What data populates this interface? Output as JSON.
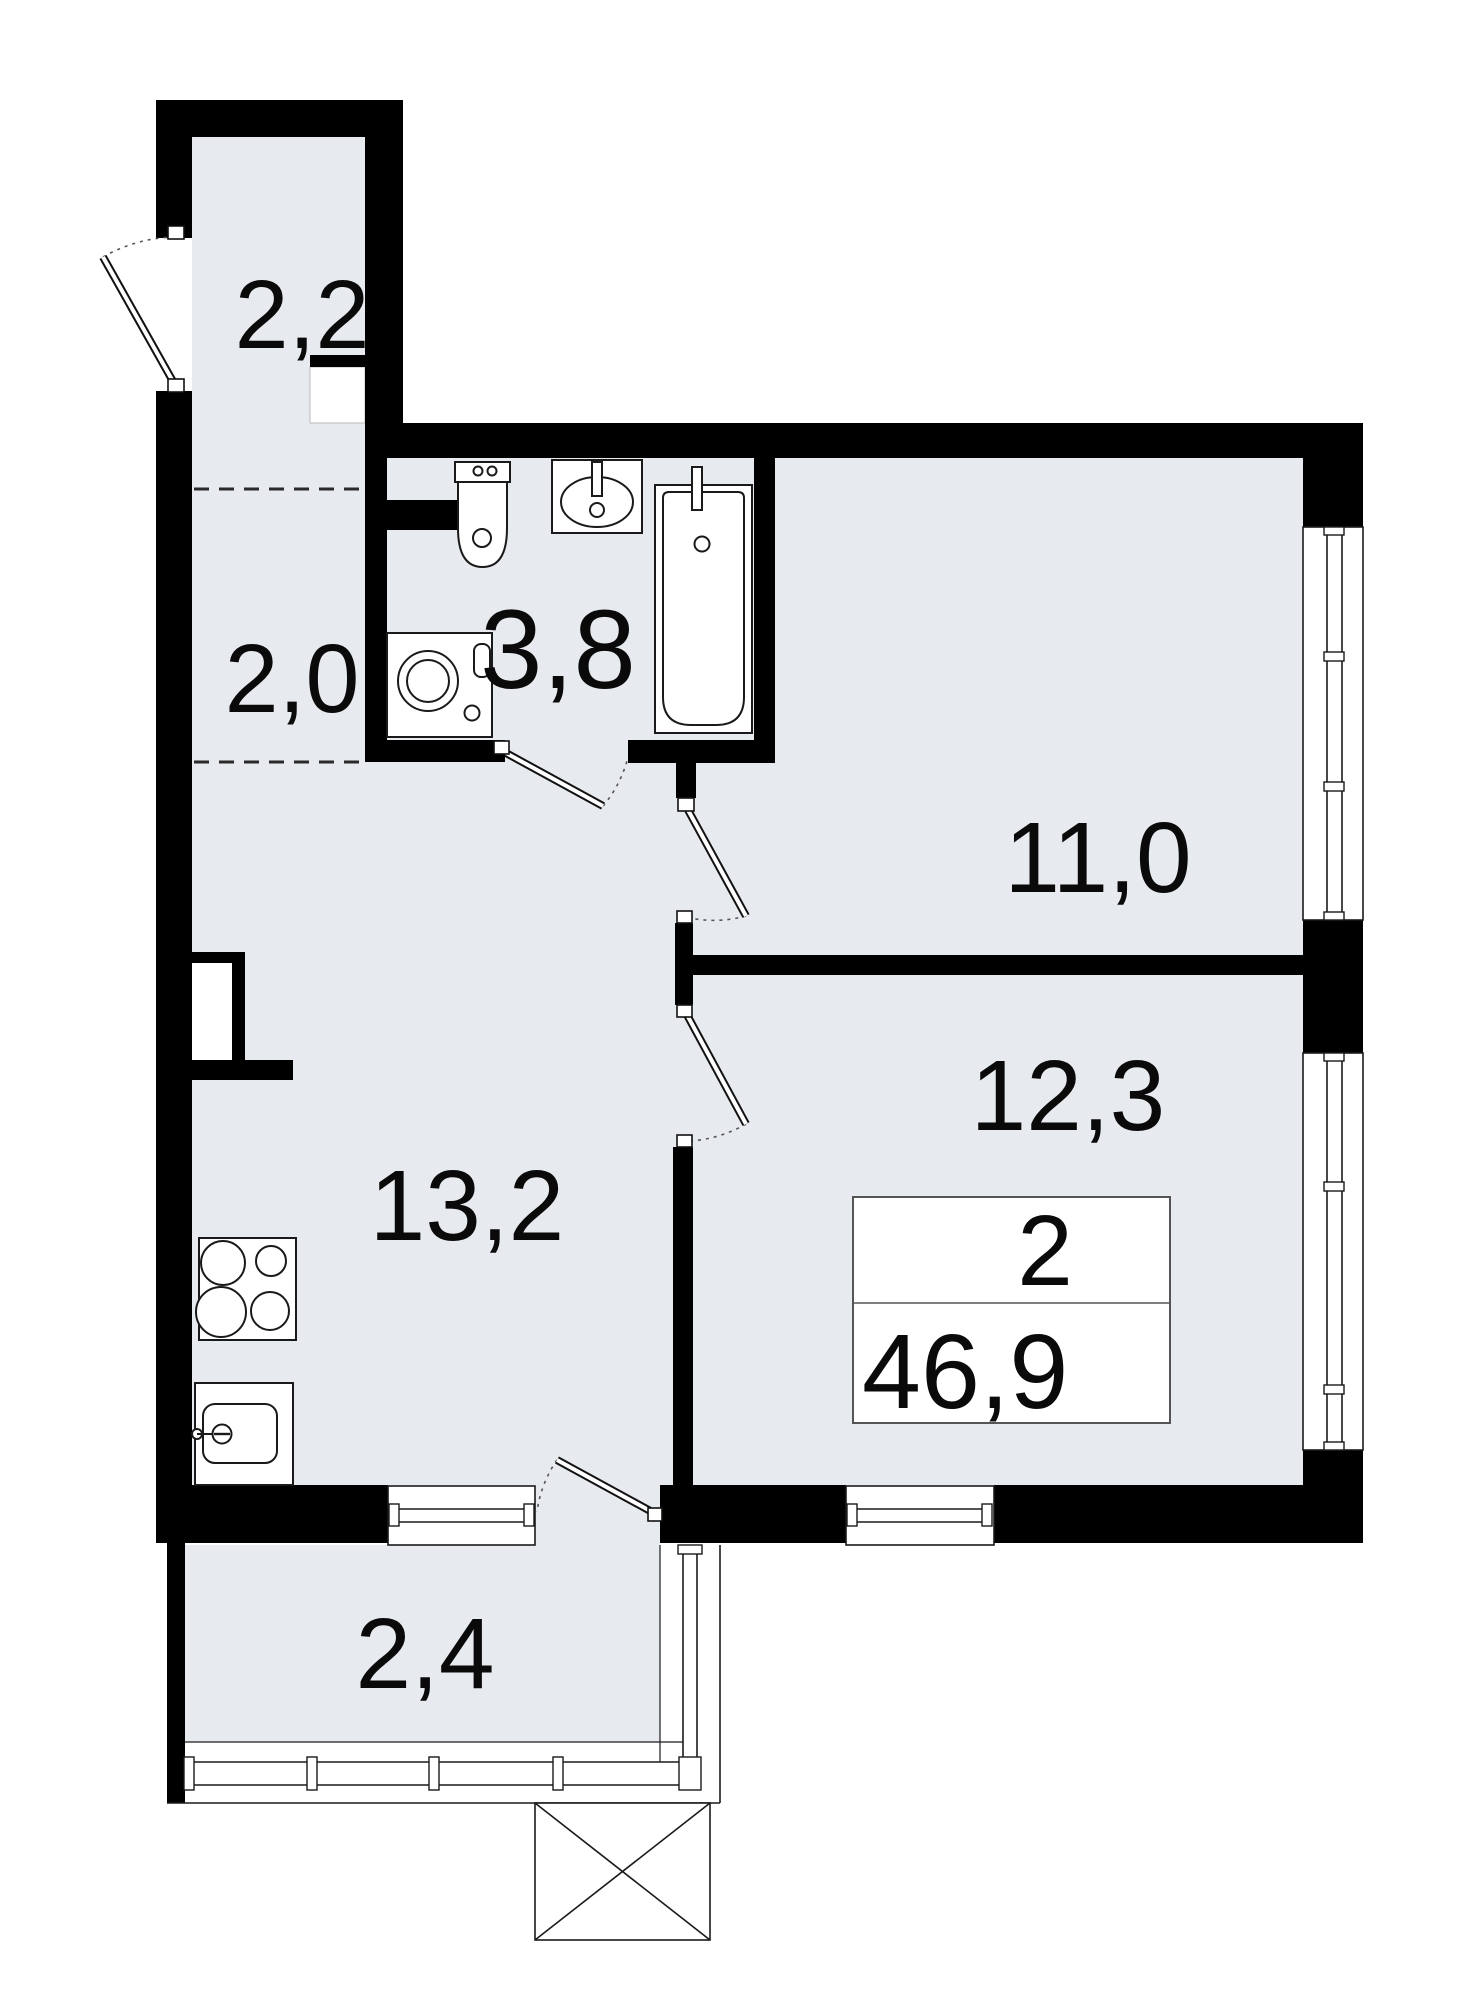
{
  "plan": {
    "type": "apartment-floor-plan",
    "rooms": [
      {
        "id": "entry-hall-upper",
        "area": "2,2"
      },
      {
        "id": "entry-hall-lower",
        "area": "2,0"
      },
      {
        "id": "bathroom",
        "area": "3,8"
      },
      {
        "id": "bedroom",
        "area": "11,0"
      },
      {
        "id": "room-second",
        "area": "12,3"
      },
      {
        "id": "kitchen-living",
        "area": "13,2"
      },
      {
        "id": "balcony",
        "area": "2,4"
      }
    ],
    "summary": {
      "rooms_count": "2",
      "total_area": "46,9"
    },
    "colors": {
      "floor_fill": "#e7eaee",
      "wall_fill": "#000000",
      "line_color": "#1a1a1a",
      "background": "#ffffff"
    }
  }
}
